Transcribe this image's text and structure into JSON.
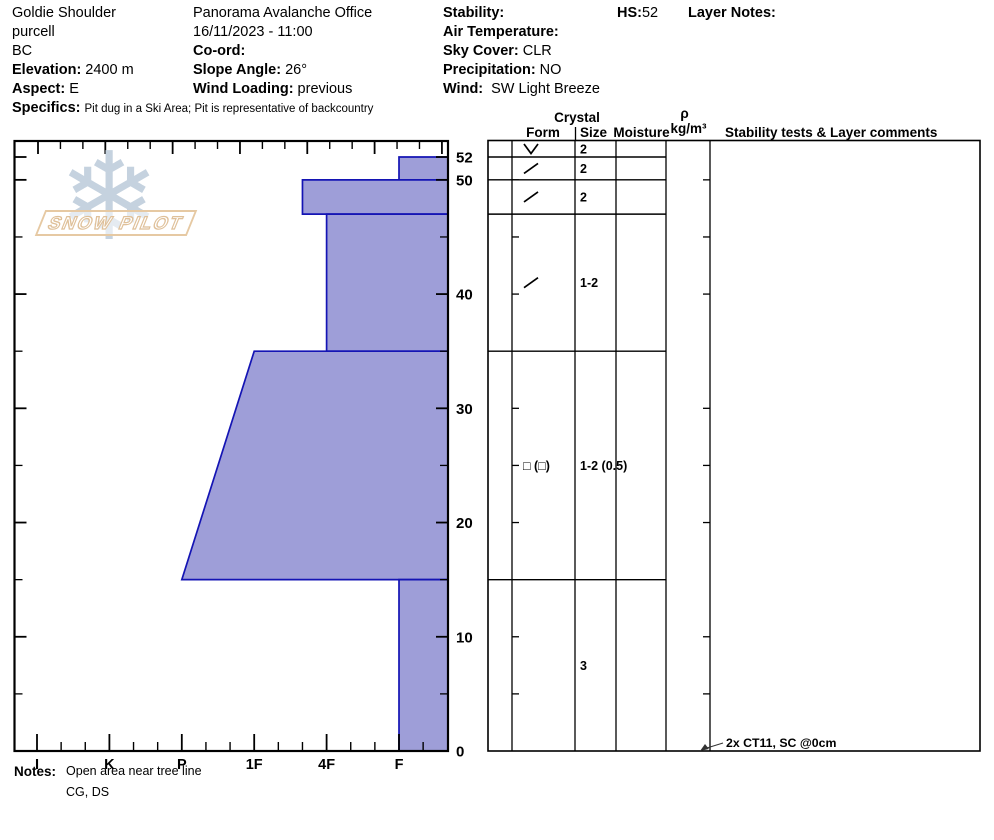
{
  "header": {
    "location": {
      "site": "Goldie Shoulder",
      "range": "purcell",
      "region": "BC",
      "elevation_label": "Elevation:",
      "elevation": "2400 m",
      "aspect_label": "Aspect:",
      "aspect": "E",
      "specifics_label": "Specifics:",
      "specifics": "Pit dug in a Ski Area; Pit is representative of backcountry"
    },
    "observation": {
      "office": "Panorama Avalanche Office",
      "datetime": "16/11/2023 - 11:00",
      "coord_label": "Co-ord:",
      "slope_angle_label": "Slope Angle:",
      "slope_angle": "26°",
      "wind_loading_label": "Wind Loading:",
      "wind_loading": "previous"
    },
    "conditions": {
      "stability_label": "Stability:",
      "air_temp_label": "Air Temperature:",
      "sky_label": "Sky Cover:",
      "sky": "CLR",
      "precip_label": "Precipitation:",
      "precip": "NO",
      "wind_label": "Wind:",
      "wind": "SW Light Breeze"
    },
    "hs_label": "HS:",
    "hs": "52",
    "layer_notes_label": "Layer Notes:"
  },
  "logo": {
    "text": "SNOW PILOT",
    "snowflake": "❄"
  },
  "notes": {
    "label": "Notes:",
    "line1": "Open area near tree line",
    "line2": "CG, DS"
  },
  "chart_data": {
    "type": "bar",
    "orientation": "horizontal-hardness-profile",
    "title": "",
    "xlabel": "",
    "ylabel": "",
    "x_axis": {
      "hardness_ticks": [
        "I",
        "K",
        "P",
        "1F",
        "4F",
        "F"
      ],
      "hard_side": "left"
    },
    "y_axis": {
      "unit": "cm",
      "max_cm": 52,
      "tick_labels": [
        {
          "cm": 52,
          "label": "52"
        },
        {
          "cm": 50,
          "label": "50"
        },
        {
          "cm": 40,
          "label": "40"
        },
        {
          "cm": 30,
          "label": "30"
        },
        {
          "cm": 20,
          "label": "20"
        },
        {
          "cm": 10,
          "label": "10"
        },
        {
          "cm": 0,
          "label": "0"
        }
      ]
    },
    "top_axis": {
      "name": "temperature-axis",
      "labels": []
    },
    "layers": [
      {
        "top_cm": 52,
        "bottom_cm": 50,
        "hardness_top": "F",
        "hardness_bottom": "F"
      },
      {
        "top_cm": 50,
        "bottom_cm": 47,
        "hardness_top": "4F+",
        "hardness_bottom": "4F+"
      },
      {
        "top_cm": 47,
        "bottom_cm": 35,
        "hardness_top": "4F",
        "hardness_bottom": "4F"
      },
      {
        "top_cm": 35,
        "bottom_cm": 15,
        "hardness_top": "1F",
        "hardness_bottom": "P"
      },
      {
        "top_cm": 15,
        "bottom_cm": 0,
        "hardness_top": "F",
        "hardness_bottom": "F"
      }
    ]
  },
  "grain_table": {
    "headers": {
      "crystal": "Crystal",
      "form": "Form",
      "size": "Size",
      "moisture": "Moisture",
      "density_rho": "ρ",
      "density_unit": "kg/m³",
      "comments": "Stability tests & Layer comments"
    },
    "rows": [
      {
        "top_cm": 53.4,
        "bottom_cm": 52,
        "form_glyph": "V",
        "form_name": "surface-hoar",
        "size": "2",
        "moisture": ""
      },
      {
        "top_cm": 52,
        "bottom_cm": 50,
        "form_glyph": "/",
        "form_name": "decomposing-fragments",
        "size": "2",
        "moisture": ""
      },
      {
        "top_cm": 50,
        "bottom_cm": 47,
        "form_glyph": "/",
        "form_name": "decomposing-fragments",
        "size": "2",
        "moisture": ""
      },
      {
        "top_cm": 47,
        "bottom_cm": 35,
        "form_glyph": "/",
        "form_name": "decomposing-fragments",
        "size": "1-2",
        "moisture": ""
      },
      {
        "top_cm": 35,
        "bottom_cm": 15,
        "form_glyph": "□ (□)",
        "form_name": "faceted-crystals",
        "size": "1-2 (0.5)",
        "moisture": ""
      },
      {
        "top_cm": 15,
        "bottom_cm": 0,
        "form_glyph": "",
        "form_name": "none",
        "size": "3",
        "moisture": ""
      }
    ],
    "annotation": {
      "text": "2x CT11, SC @0cm",
      "at_cm": 0
    }
  },
  "colors": {
    "layer_fill": "#9e9ed8",
    "layer_stroke": "#1414b4",
    "axis": "#000000",
    "logo_snowflake": "#c5d2df",
    "logo_band": "#e6c9a3"
  }
}
